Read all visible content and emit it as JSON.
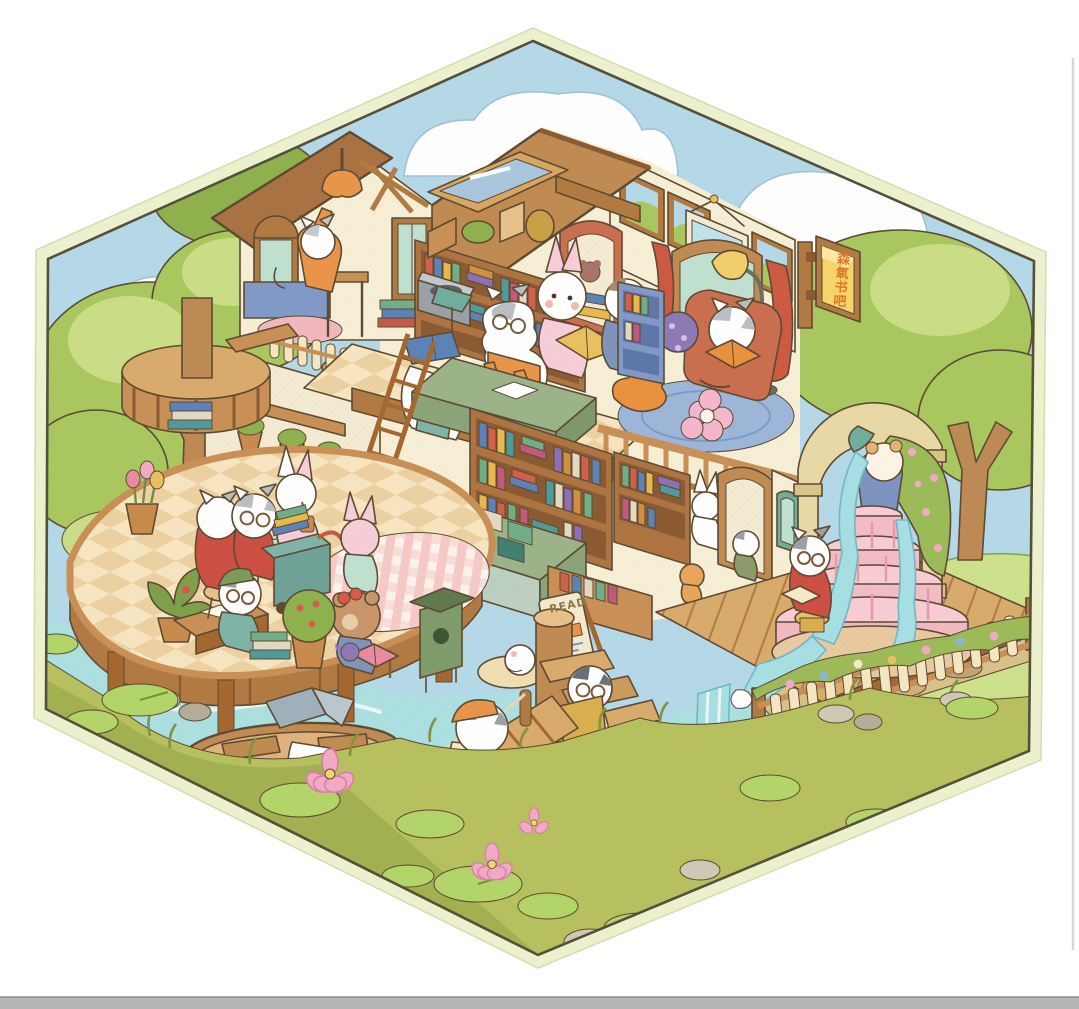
{
  "artwork": {
    "type": "isometric-illustration",
    "subject": "Cartoon animal characters in a two-story forest book bar with reading deck, waterfall fountain, river, wooden bridge and boats, inside a hexagonal frame",
    "frame": {
      "shape": "hexagon",
      "border_color": "#edf0cd",
      "outline_color": "#55503c",
      "background_outside": "#ffffff"
    },
    "signs": {
      "hanging_sign": {
        "text": "森氧书吧",
        "text_color": "#e0762a",
        "board_color": "#f6d56b"
      },
      "standing_sign": {
        "text": "READ",
        "text_color": "#8a7a4a",
        "board_color": "#f3e9cf"
      }
    },
    "palette": {
      "sky": "#b5d8e8",
      "cloud": "#ffffff",
      "foliage_light": "#cadd85",
      "foliage": "#a9c75f",
      "foliage_dark": "#8fb14d",
      "trunk": "#bd8a55",
      "wood": "#cd9a5e",
      "wood_dark": "#b07a42",
      "wood_light": "#e8c089",
      "wall_cream": "#f7eed6",
      "roof_wood": "#c08b52",
      "curtain_red": "#cc5a42",
      "armchair": "#c96f4f",
      "desk_sage": "#9cb389",
      "shelf_brown": "#ad7442",
      "water": "#abdfe0",
      "water_light": "#e9f7f5",
      "grass_bank": "#b7c05e",
      "grass_dark": "#93a648",
      "fountain_pink": "#f3bcc4",
      "fountain_pink_dark": "#e49aa8",
      "stone_arch": "#e7d8a6",
      "fence_cream": "#f4e6c0",
      "lotus_pink": "#f2a9c5",
      "lilypad": "#b2d469",
      "checker_a": "#f6e5c0",
      "checker_b": "#ecd1a2"
    },
    "characters": [
      "cat-on-chair-in-attic",
      "cat-with-blue-book-on-head",
      "cat-glasses-reading-at-desk",
      "pink-rabbit-with-yellow-book",
      "dog-in-blue",
      "grey-cat-reading-in-armchair",
      "white-cat-red-sweater-on-stool",
      "tabby-cat-with-glasses",
      "rabbit-drinking-cup",
      "cat-green-cap-at-desk",
      "pink-bunny-standing",
      "bear-with-red-bow-reading",
      "hamster-with-red-bow-browsing",
      "white-rabbit-by-arch",
      "cat-in-doorway",
      "cat-with-glasses-on-stool-by-fountain",
      "hamster-statue-pouring-water",
      "cat-carrying-box-on-stairs",
      "dog-with-orange-cap-on-bridge",
      "sleeping-cat-in-rowboat",
      "dog-rowing-round-tub-boat",
      "rubber-duck"
    ]
  }
}
